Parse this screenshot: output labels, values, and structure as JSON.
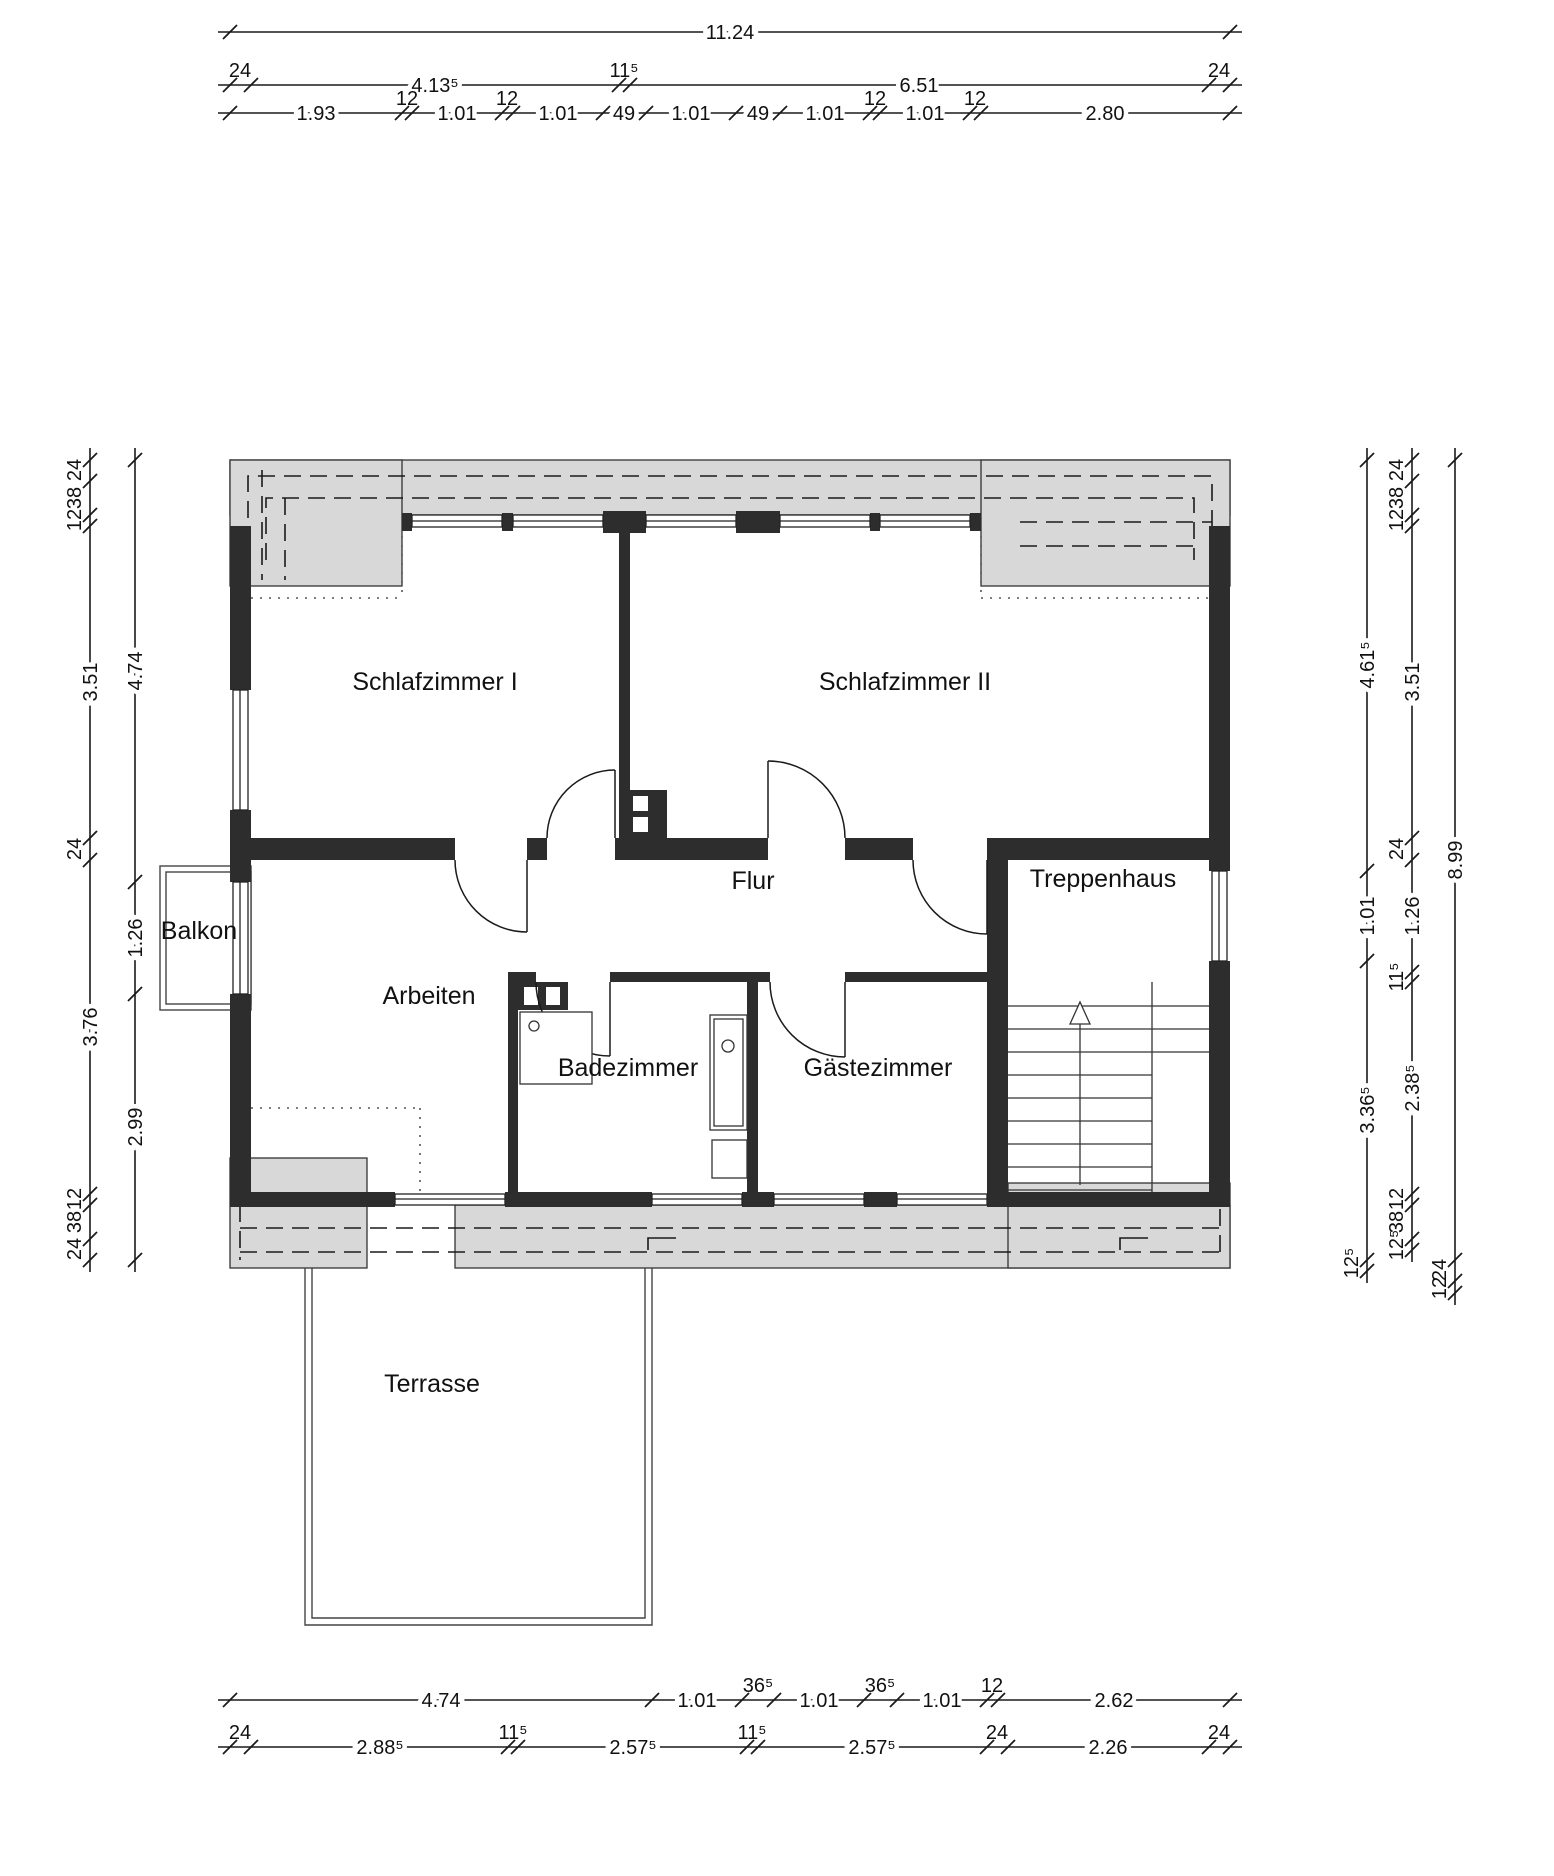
{
  "drawing_type": "floor-plan",
  "colors": {
    "wall": "#2d2d2d",
    "roof_overhang_fill": "#d8d8d8",
    "line": "#1a1a1a",
    "background": "#ffffff"
  },
  "rooms": [
    {
      "id": "schlafzimmer-1",
      "label": "Schlafzimmer I",
      "x": 435,
      "y": 690
    },
    {
      "id": "schlafzimmer-2",
      "label": "Schlafzimmer II",
      "x": 905,
      "y": 690
    },
    {
      "id": "flur",
      "label": "Flur",
      "x": 753,
      "y": 889
    },
    {
      "id": "treppenhaus",
      "label": "Treppenhaus",
      "x": 1103,
      "y": 887
    },
    {
      "id": "arbeiten",
      "label": "Arbeiten",
      "x": 429,
      "y": 1004
    },
    {
      "id": "balkon",
      "label": "Balkon",
      "x": 199,
      "y": 939
    },
    {
      "id": "badezimmer",
      "label": "Badezimmer",
      "x": 628,
      "y": 1076
    },
    {
      "id": "gaestezimmer",
      "label": "Gästezimmer",
      "x": 878,
      "y": 1076
    },
    {
      "id": "terrasse",
      "label": "Terrasse",
      "x": 432,
      "y": 1392
    }
  ],
  "dim_chains": [
    {
      "id": "top-overall",
      "orient": "h",
      "pos": 32,
      "ticks": [
        230,
        1230
      ],
      "labels": [
        {
          "t": "11.24",
          "at": 730,
          "side": false
        }
      ]
    },
    {
      "id": "top-main",
      "orient": "h",
      "pos": 85,
      "ticks": [
        230,
        251,
        619,
        630,
        1209,
        1230
      ],
      "labels": [
        {
          "t": "24",
          "at": 240,
          "side": true
        },
        {
          "t": "4.13⁵",
          "at": 435,
          "side": false
        },
        {
          "t": "11⁵",
          "at": 624,
          "side": true
        },
        {
          "t": "6.51",
          "at": 919,
          "side": false
        },
        {
          "t": "24",
          "at": 1219,
          "side": true
        }
      ]
    },
    {
      "id": "top-windows",
      "orient": "h",
      "pos": 113,
      "ticks": [
        230,
        402,
        412,
        502,
        513,
        603,
        646,
        736,
        780,
        870,
        880,
        970,
        981,
        1230
      ],
      "labels": [
        {
          "t": "1.93",
          "at": 316,
          "side": false
        },
        {
          "t": "12",
          "at": 407,
          "side": true
        },
        {
          "t": "1.01",
          "at": 457,
          "side": false
        },
        {
          "t": "12",
          "at": 507,
          "side": true
        },
        {
          "t": "1.01",
          "at": 558,
          "side": false
        },
        {
          "t": "49",
          "at": 624,
          "side": false
        },
        {
          "t": "1.01",
          "at": 691,
          "side": false
        },
        {
          "t": "49",
          "at": 758,
          "side": false
        },
        {
          "t": "1.01",
          "at": 825,
          "side": false
        },
        {
          "t": "12",
          "at": 875,
          "side": true
        },
        {
          "t": "1.01",
          "at": 925,
          "side": false
        },
        {
          "t": "12",
          "at": 975,
          "side": true
        },
        {
          "t": "2.80",
          "at": 1105,
          "side": false
        }
      ]
    },
    {
      "id": "bottom-windows",
      "orient": "h",
      "pos": 1700,
      "ticks": [
        230,
        652,
        742,
        774,
        864,
        897,
        987,
        998,
        1230
      ],
      "labels": [
        {
          "t": "4.74",
          "at": 441,
          "side": false
        },
        {
          "t": "1.01",
          "at": 697,
          "side": false
        },
        {
          "t": "36⁵",
          "at": 758,
          "side": true
        },
        {
          "t": "1.01",
          "at": 819,
          "side": false
        },
        {
          "t": "36⁵",
          "at": 880,
          "side": true
        },
        {
          "t": "1.01",
          "at": 942,
          "side": false
        },
        {
          "t": "12",
          "at": 992,
          "side": true
        },
        {
          "t": "2.62",
          "at": 1114,
          "side": false
        }
      ]
    },
    {
      "id": "bottom-main",
      "orient": "h",
      "pos": 1747,
      "ticks": [
        230,
        251,
        508,
        518,
        747,
        758,
        987,
        1008,
        1209,
        1230
      ],
      "labels": [
        {
          "t": "24",
          "at": 240,
          "side": true
        },
        {
          "t": "2.88⁵",
          "at": 380,
          "side": false
        },
        {
          "t": "11⁵",
          "at": 513,
          "side": true
        },
        {
          "t": "2.57⁵",
          "at": 633,
          "side": false
        },
        {
          "t": "11⁵",
          "at": 752,
          "side": true
        },
        {
          "t": "2.57⁵",
          "at": 872,
          "side": false
        },
        {
          "t": "24",
          "at": 997,
          "side": true
        },
        {
          "t": "2.26",
          "at": 1108,
          "side": false
        },
        {
          "t": "24",
          "at": 1219,
          "side": true
        }
      ]
    },
    {
      "id": "left-outer",
      "orient": "v",
      "pos": 90,
      "ticks": [
        460,
        481,
        515,
        526,
        838,
        860,
        1194,
        1205,
        1239,
        1260
      ],
      "labels": [
        {
          "t": "24",
          "at": 470,
          "side": true
        },
        {
          "t": "38",
          "at": 498,
          "side": true
        },
        {
          "t": "12",
          "at": 520,
          "side": true
        },
        {
          "t": "3.51",
          "at": 682,
          "side": false
        },
        {
          "t": "24",
          "at": 849,
          "side": true
        },
        {
          "t": "3.76",
          "at": 1027,
          "side": false
        },
        {
          "t": "12",
          "at": 1199,
          "side": true
        },
        {
          "t": "38",
          "at": 1222,
          "side": true
        },
        {
          "t": "24",
          "at": 1249,
          "side": true
        }
      ]
    },
    {
      "id": "left-inner",
      "orient": "v",
      "pos": 135,
      "ticks": [
        460,
        882,
        994,
        1260
      ],
      "labels": [
        {
          "t": "4.74",
          "at": 671,
          "side": false
        },
        {
          "t": "1.26",
          "at": 938,
          "side": false
        },
        {
          "t": "2.99",
          "at": 1127,
          "side": false
        }
      ]
    },
    {
      "id": "right-inner",
      "orient": "v",
      "pos": 1367,
      "ticks": [
        460,
        871,
        961,
        1260,
        1271
      ],
      "labels": [
        {
          "t": "4.61⁵",
          "at": 665,
          "side": false
        },
        {
          "t": "1.01",
          "at": 916,
          "side": false
        },
        {
          "t": "3.36⁵",
          "at": 1110,
          "side": false
        },
        {
          "t": "12⁵",
          "at": 1263,
          "side": true
        }
      ]
    },
    {
      "id": "right-mid",
      "orient": "v",
      "pos": 1412,
      "ticks": [
        460,
        481,
        515,
        526,
        838,
        860,
        972,
        982,
        1194,
        1205,
        1239,
        1250
      ],
      "labels": [
        {
          "t": "24",
          "at": 470,
          "side": true
        },
        {
          "t": "38",
          "at": 498,
          "side": true
        },
        {
          "t": "12",
          "at": 520,
          "side": true
        },
        {
          "t": "3.51",
          "at": 682,
          "side": false
        },
        {
          "t": "24",
          "at": 849,
          "side": true
        },
        {
          "t": "1.26",
          "at": 916,
          "side": false
        },
        {
          "t": "11⁵",
          "at": 977,
          "side": true
        },
        {
          "t": "2.38⁵",
          "at": 1088,
          "side": false
        },
        {
          "t": "12",
          "at": 1199,
          "side": true
        },
        {
          "t": "38",
          "at": 1222,
          "side": true
        },
        {
          "t": "12⁵",
          "at": 1245,
          "side": true
        }
      ]
    },
    {
      "id": "right-overall",
      "orient": "v",
      "pos": 1455,
      "ticks": [
        460,
        1260,
        1281,
        1293
      ],
      "labels": [
        {
          "t": "8.99",
          "at": 860,
          "side": false
        },
        {
          "t": "24",
          "at": 1270,
          "side": true
        },
        {
          "t": "12",
          "at": 1288,
          "side": true
        }
      ]
    }
  ]
}
